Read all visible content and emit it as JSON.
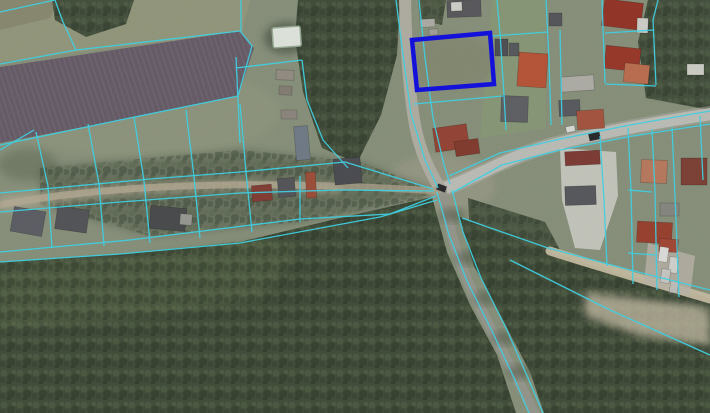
{
  "map": {
    "kind": "aerial-cadastral-map",
    "viewport": {
      "width": 710,
      "height": 413
    },
    "colors": {
      "grass_base": "#8f9882",
      "field_plough": "#6c616c",
      "field_furrow": "#7e7383",
      "forest": "#47523f",
      "forest_light": "#6a7a55",
      "road_paved": "#c6c6c0",
      "road_gravel": "#b8b6aa",
      "road_shaded": "#9d9d94",
      "road_dirt": "#b3a991",
      "road_sand": "#cdc4a9",
      "pond": "#e9efe7",
      "parcel_line": "#3fcfe0",
      "highlight_parcel": "#1411da"
    },
    "field": {
      "name": "ploughed-field",
      "points": "0,67 240,31 254,48 238,96 120,120 0,143"
    },
    "patches": [
      {
        "name": "grass-light-topleft",
        "kind": "poly",
        "points": "0,0 250,0 242,32 0,62",
        "fill": "#9ba083",
        "opacity": 0.9
      },
      {
        "name": "grass-corner-brown",
        "kind": "poly",
        "points": "0,0 58,0 50,18 0,30",
        "fill": "#8b8a74",
        "opacity": 0.7
      },
      {
        "name": "grass-mid-light",
        "kind": "ellipse",
        "cx": 140,
        "cy": 112,
        "rx": 140,
        "ry": 46,
        "fill": "#9aa186",
        "opacity": 0.55,
        "soft": true
      },
      {
        "name": "grass-right-bright",
        "kind": "poly",
        "points": "492,0 545,0 546,128 480,138",
        "fill": "#8fa17b",
        "opacity": 0.75
      },
      {
        "name": "scrub-highlight-parcel",
        "kind": "ellipse",
        "cx": 452,
        "cy": 62,
        "rx": 45,
        "ry": 28,
        "fill": "#8b9078",
        "opacity": 0.9,
        "soft": true
      },
      {
        "name": "grass-worn-junction",
        "kind": "ellipse",
        "cx": 440,
        "cy": 185,
        "rx": 55,
        "ry": 30,
        "fill": "#a8a592",
        "opacity": 0.55,
        "soft": true
      },
      {
        "name": "bushes-left-edge",
        "kind": "ellipse",
        "cx": 28,
        "cy": 165,
        "rx": 30,
        "ry": 16,
        "fill": "#5c6850",
        "opacity": 0.4,
        "soft": true
      }
    ],
    "forests": [
      {
        "name": "forest-south-main",
        "points": "0,262 120,254 240,242 340,218 432,197 447,252 470,305 497,355 516,413 0,413",
        "opacity": 1,
        "canopy": 0.55
      },
      {
        "name": "forest-southeast",
        "points": "458,216 530,246 620,274 710,298 710,413 544,413 530,372 504,322 474,266",
        "opacity": 1,
        "canopy": 0.55
      },
      {
        "name": "forest-center-top",
        "points": "298,0 400,0 397,55 381,115 357,163 322,148 303,92 295,38",
        "opacity": 1,
        "canopy": 0.5
      },
      {
        "name": "tree-clump-topleft",
        "points": "52,0 134,0 126,24 86,37 55,20",
        "opacity": 0.95,
        "canopy": 0.5
      },
      {
        "name": "forest-northeast-corner",
        "points": "648,0 710,0 710,110 646,98 638,42",
        "opacity": 0.95,
        "canopy": 0.5
      },
      {
        "name": "tree-row-road-top",
        "points": "418,0 446,0 442,25 420,20",
        "opacity": 0.8,
        "canopy": 0.4
      },
      {
        "name": "tree-band-parcel-fan",
        "points": "40,168 240,150 360,162 430,188 428,198 300,222 150,236 40,204",
        "opacity": 0.45,
        "canopy": 0.35,
        "soft": true
      },
      {
        "name": "tree-clump-junction-east",
        "points": "468,198 545,222 560,250 520,258 470,235",
        "opacity": 0.85,
        "canopy": 0.45
      },
      {
        "name": "deciduous-band-forest-edge",
        "points": "0,268 120,258 260,238 300,250 260,300 120,320 0,330",
        "fill": "#6a7a55",
        "opacity": 0.35,
        "canopy": 0.3,
        "soft": true
      }
    ],
    "roads": [
      {
        "name": "main-road-shoulder",
        "d": "M441,189 C470,181 500,160 545,147 C600,132 660,122 710,114",
        "fill": "#b6b6ac",
        "width": 16,
        "opacity": 0.5
      },
      {
        "name": "main-road",
        "d": "M441,189 C470,181 500,160 545,147 C600,132 660,122 710,114",
        "fill": "#c6c6c0",
        "width": 12,
        "opacity": 1
      },
      {
        "name": "gravel-road-north",
        "d": "M405,0 C406,40 408,85 415,125 C420,152 430,172 441,190",
        "fill": "#b8b6aa",
        "width": 12,
        "opacity": 1
      },
      {
        "name": "forest-road-south",
        "d": "M442,192 C449,228 458,262 475,297 C491,330 508,362 524,392 L534,413",
        "fill": "#9d9d94",
        "width": 10,
        "opacity": 0.95
      },
      {
        "name": "dirt-track-west",
        "d": "M438,191 C360,186 260,182 160,187 C100,190 40,197 0,205",
        "fill": "#b3a991",
        "width": 7,
        "opacity": 0.8
      },
      {
        "name": "sandy-road-southeast",
        "d": "M550,251 C600,267 655,283 710,299",
        "fill": "#cdc4a9",
        "width": 9,
        "opacity": 0.95
      }
    ],
    "surfaces": [
      {
        "name": "sand-track-verge",
        "kind": "poly",
        "points": "0,196 120,185 240,180 340,185 340,193 240,188 120,195 0,211",
        "fill": "#c4baa2",
        "opacity": 0.6,
        "soft": true
      },
      {
        "name": "sand-patch-southeast",
        "kind": "poly",
        "points": "585,292 700,306 710,312 710,345 640,336 585,316",
        "fill": "#cfc6ae",
        "opacity": 0.75,
        "soft": true
      },
      {
        "name": "paved-yard-white",
        "kind": "poly",
        "points": "560,148 616,152 618,196 600,250 575,248 562,200",
        "fill": "#d8d8d1",
        "opacity": 0.85
      },
      {
        "name": "parking-area-trucks",
        "kind": "poly",
        "points": "648,243 695,256 690,296 644,283",
        "fill": "#c2bdb0",
        "opacity": 0.8
      }
    ],
    "shadow_dapples": [
      {
        "cx": 452,
        "cy": 215
      },
      {
        "cx": 468,
        "cy": 258
      },
      {
        "cx": 486,
        "cy": 298
      },
      {
        "cx": 504,
        "cy": 338
      },
      {
        "cx": 519,
        "cy": 372
      }
    ],
    "pond": {
      "name": "pond",
      "x": 272,
      "y": 28,
      "w": 28,
      "h": 20
    },
    "buildings": {
      "format": [
        "name",
        "x",
        "y",
        "w",
        "h",
        "rot",
        "fill"
      ],
      "items": [
        [
          "building-top-house",
          447,
          0,
          34,
          17,
          -2,
          "#5f5f63"
        ],
        [
          "building-top-house-white",
          451,
          2,
          11,
          9,
          -2,
          "#d9d9d3"
        ],
        [
          "shed-roadside-1",
          420,
          19,
          15,
          8,
          -3,
          "#b5b5ad"
        ],
        [
          "shed-roadside-2",
          429,
          29,
          9,
          6,
          -3,
          "#a8a8a0"
        ],
        [
          "red-house-junction",
          434,
          126,
          34,
          24,
          -8,
          "#9c4a3a"
        ],
        [
          "red-house-junction-wing",
          455,
          140,
          24,
          15,
          -8,
          "#8a4034"
        ],
        [
          "dark-house-center",
          334,
          158,
          27,
          26,
          -5,
          "#515257"
        ],
        [
          "red-building-center",
          306,
          172,
          10,
          26,
          -3,
          "#a4543e"
        ],
        [
          "red-house-left-center",
          252,
          185,
          20,
          16,
          -5,
          "#8a4238"
        ],
        [
          "gray-building-center",
          278,
          178,
          17,
          19,
          -5,
          "#5a5b5f"
        ],
        [
          "containers-blue",
          295,
          126,
          14,
          34,
          -5,
          "#76828e"
        ],
        [
          "left-house-1",
          12,
          209,
          32,
          25,
          10,
          "#62646b"
        ],
        [
          "left-house-2",
          56,
          208,
          32,
          23,
          8,
          "#585a5e"
        ],
        [
          "left-barn",
          150,
          207,
          36,
          23,
          5,
          "#4e5052"
        ],
        [
          "left-barn-annex",
          180,
          214,
          12,
          11,
          5,
          "#9fa09a"
        ],
        [
          "farm-shed-1",
          276,
          70,
          18,
          10,
          2,
          "#9a948a"
        ],
        [
          "farm-shed-2",
          279,
          86,
          13,
          9,
          2,
          "#8b857b"
        ],
        [
          "farm-shed-3",
          281,
          110,
          16,
          9,
          0,
          "#938d85"
        ],
        [
          "orange-roof-house",
          518,
          53,
          29,
          34,
          4,
          "#bf5a3c"
        ],
        [
          "gray-house-east-1",
          501,
          96,
          27,
          26,
          2,
          "#65666a"
        ],
        [
          "dark-shed-east-1",
          495,
          39,
          13,
          17,
          0,
          "#54555a"
        ],
        [
          "dark-shed-east-2",
          509,
          43,
          10,
          13,
          0,
          "#5e5f63"
        ],
        [
          "long-barn-light",
          561,
          76,
          33,
          15,
          -4,
          "#b7b5ae"
        ],
        [
          "dark-house-mid-east",
          559,
          100,
          21,
          16,
          -3,
          "#5f6066"
        ],
        [
          "red-house-mid-east",
          577,
          110,
          27,
          19,
          -4,
          "#ad5a44"
        ],
        [
          "corner-barn-1",
          603,
          1,
          39,
          27,
          7,
          "#9c392c"
        ],
        [
          "corner-barn-2",
          605,
          47,
          35,
          23,
          6,
          "#a03d2e"
        ],
        [
          "corner-salmon-house",
          624,
          64,
          25,
          19,
          6,
          "#c47455"
        ],
        [
          "corner-white-shed",
          637,
          18,
          11,
          15,
          2,
          "#d8d8d2"
        ],
        [
          "small-house-top-east",
          549,
          13,
          13,
          13,
          0,
          "#5b5c60"
        ],
        [
          "long-red-building",
          565,
          151,
          35,
          14,
          -3,
          "#85403a"
        ],
        [
          "gray-house-yard",
          565,
          186,
          31,
          19,
          -2,
          "#5d5e63"
        ],
        [
          "pink-house-east",
          641,
          160,
          26,
          23,
          2,
          "#c08064"
        ],
        [
          "dark-red-house-east",
          681,
          158,
          26,
          27,
          0,
          "#84463a"
        ],
        [
          "red-cluster-south-1",
          637,
          222,
          35,
          21,
          3,
          "#a04634"
        ],
        [
          "red-cluster-south-2",
          659,
          239,
          19,
          13,
          3,
          "#aa4c3a"
        ],
        [
          "gray-shed-southeast",
          660,
          203,
          19,
          13,
          0,
          "#8d8e87"
        ],
        [
          "white-shed-in-trees",
          687,
          64,
          17,
          11,
          0,
          "#d6d6cf"
        ]
      ]
    },
    "vehicles": {
      "format": [
        "name",
        "x",
        "y",
        "w",
        "h",
        "rot",
        "fill"
      ],
      "items": [
        [
          "car-at-junction",
          437,
          185,
          9,
          6,
          20,
          "#2e2f33"
        ],
        [
          "car-on-main-road",
          589,
          133,
          11,
          7,
          -12,
          "#2c2d31"
        ],
        [
          "white-car-main-road",
          566,
          126,
          9,
          6,
          -12,
          "#e2e2de"
        ],
        [
          "truck-1",
          659,
          247,
          9,
          15,
          8,
          "#e6e6e2"
        ],
        [
          "truck-2",
          669,
          257,
          9,
          16,
          8,
          "#dadad6"
        ],
        [
          "truck-3",
          661,
          269,
          9,
          14,
          8,
          "#cfcfcb"
        ],
        [
          "truck-4",
          670,
          281,
          8,
          12,
          8,
          "#c6c6c2"
        ]
      ]
    },
    "parcel_lines": [
      "0,12 55,0",
      "55,0 63,22 76,50",
      "0,64 76,50 240,31 252,46",
      "0,145 120,120 238,96 252,46",
      "241,0 241,31",
      "236,57 240,143",
      "236,68 302,60",
      "302,60 307,100 323,140 348,168",
      "0,150 34,130",
      "36,132 48,186 52,248",
      "88,124 99,184 104,246",
      "134,117 144,181 150,243",
      "186,110 194,177 200,238",
      "240,104 246,172 252,232",
      "0,193 150,179 240,172 345,162 433,189",
      "0,212 120,202 240,193 340,190 434,191",
      "0,252 130,240 300,219 390,214 436,196",
      "0,262 120,254 240,243 380,217 437,200",
      "300,176 300,222",
      "396,0 403,55 411,114 425,160 438,188",
      "419,0 425,58 433,118 444,165 450,184",
      "497,0 500,33",
      "414,104 503,96",
      "500,33 504,95 506,130",
      "492,36 548,32",
      "546,0 549,60 551,125",
      "560,30 562,125",
      "449,176 500,153 560,139 630,125 710,111",
      "452,193 502,165 560,150 633,136 710,124",
      "600,136 604,200 607,266",
      "628,128 631,190 633,284",
      "652,129 655,192 657,290",
      "672,127 676,220 679,297",
      "700,116 703,180",
      "628,190 652,192",
      "628,253 655,255",
      "437,192 449,235 467,281 492,331 515,380 529,413",
      "452,190 463,232 481,278 506,328 528,378 543,413",
      "462,218 548,248 630,270 710,290",
      "510,260 610,310 710,355",
      "602,0 605,83",
      "605,33 654,30",
      "658,0 653,20 656,85",
      "605,84 656,86"
    ],
    "highlight_parcel": {
      "name": "highlighted-parcel",
      "points": "412,40 490,33 494,84 417,90",
      "stroke_width": 4.5
    }
  }
}
